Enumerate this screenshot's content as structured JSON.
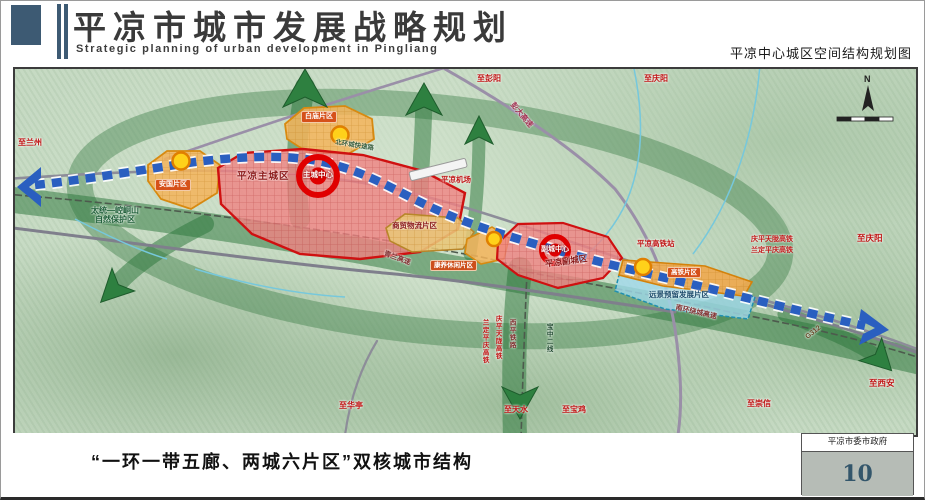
{
  "header": {
    "title": "平凉市城市发展战略规划",
    "subtitle": "Strategic planning of urban development in Pingliang",
    "map_title": "平凉中心城区空间结构规划图"
  },
  "footer": {
    "caption": "“一环一带五廊、两城六片区”双核城市结构",
    "agency": "平凉市委市政府",
    "page_number": "10"
  },
  "map": {
    "compass": "N",
    "cities": {
      "main_city": "平凉主城区",
      "main_core": "主城中心",
      "sub_city": "平凉副城区",
      "sub_core": "副城中心"
    },
    "districts": {
      "anguo": "安国片区",
      "baimiao": "白庙片区",
      "trade_logistics": "商贸物流片区",
      "leisure": "康养休闲片区",
      "hsr": "高铁片区",
      "reserved": "远景预留发展片区"
    },
    "poi": {
      "airport": "平凉机场",
      "hsr_station": "平凉高铁站",
      "nature_reserve_l1": "太统—崆峒山",
      "nature_reserve_l2": "自然保护区"
    },
    "roads": {
      "pengda_expwy": "彭大高速",
      "north_ring": "北环城快速路",
      "qinglan_expwy": "青兰高速",
      "south_ring_expwy": "南环绕城高速",
      "g312": "G312"
    },
    "railways": {
      "qingping_tianlong_hsr": "庆平天陇高铁",
      "landing_pingqing_hsr": "兰定平庆高铁",
      "xiping_railway": "西平铁路",
      "baozhong_line2": "宝中二线"
    },
    "directions": {
      "to_lanzhou": "至兰州",
      "to_pengyang": "至彭阳",
      "to_qingyang_n": "至庆阳",
      "to_qingyang_e": "至庆阳",
      "to_xian": "至西安",
      "to_chongxin": "至崇信",
      "to_huating": "至华亭",
      "to_tianshui": "至天水",
      "to_baoji": "至宝鸡"
    }
  },
  "colors": {
    "brand_blue": "#3d5a73",
    "city_red": "#d01010",
    "district_orange": "#e08a10",
    "axis_blue": "#2a5fc0",
    "corridor_green": "#2c7a3c"
  }
}
